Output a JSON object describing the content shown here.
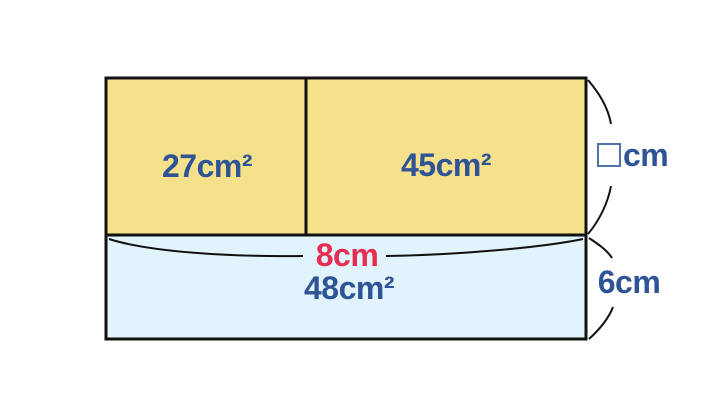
{
  "figure": {
    "areas": {
      "top_left": "27cm²",
      "top_right": "45cm²",
      "bottom": "48cm²"
    },
    "measurements": {
      "bottom_width": "8cm",
      "top_height_symbol": "□",
      "top_height_unit": "cm",
      "bottom_height": "6cm"
    },
    "colors": {
      "top_fill": "#f5e18b",
      "bottom_fill": "#e1f4fb",
      "outline": "#111111",
      "area_text": "#2f5496",
      "width_text": "#e62e52",
      "unknown_box_border": "#4f74a8"
    }
  }
}
